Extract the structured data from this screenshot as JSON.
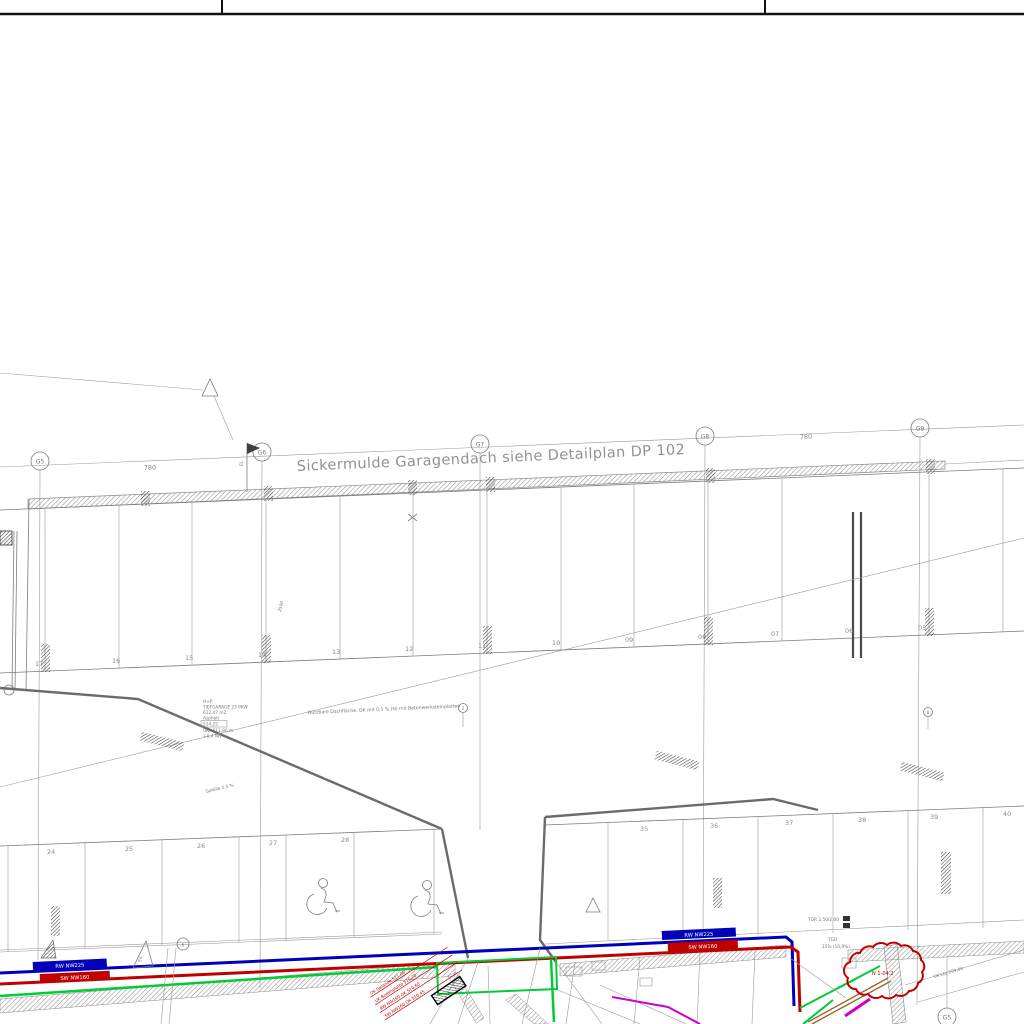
{
  "sheet": {
    "background": "#ffffff",
    "line_gray": "#7d7d7d",
    "accent_blue": "#0000bb",
    "accent_red": "#c00000",
    "accent_green": "#00cc33",
    "accent_magenta": "#cc00cc"
  },
  "title_note": "Sickermulde Garagendach siehe Detailplan DP 102",
  "grid": {
    "bubbles": [
      "G5",
      "G6",
      "G7",
      "G8",
      "G9"
    ],
    "bubble_bottom_right": "G5",
    "dims": [
      "780",
      "780"
    ],
    "flag_label": "FL"
  },
  "parking": {
    "row1": [
      "17",
      "16",
      "15",
      "14",
      "13",
      "12",
      "11",
      "10",
      "09",
      "08",
      "07",
      "06",
      "05"
    ],
    "row2_left": [
      "24",
      "25",
      "26",
      "27",
      "28"
    ],
    "row2_right": [
      "35",
      "36",
      "37",
      "38",
      "39",
      "40"
    ]
  },
  "garage_note": {
    "lines": [
      "H+P",
      "TIEFGARAGE 23 PKW",
      "612,47 m2",
      "Asphalt",
      "514,25",
      "UK=511,90 m",
      "+0,4 Niv"
    ]
  },
  "aisle_note": "Nutzbare Dachfläche, OK mit 0,5 % (N) mit Betonwerksteinplatten",
  "markers": {
    "circle_left": "6",
    "circle_mid": "2",
    "circle_right": "8",
    "triangle_label": "E4"
  },
  "pipes": {
    "storm_label": "RW NW225",
    "sewer_label": "SW NW160"
  },
  "ramp": {
    "gate_label": "TOR 2,50/2,00",
    "tgd_label": "TGD",
    "slope_label": "15% (10,9%)"
  },
  "revision_cloud_text": "N 1-04.2",
  "red_annotations": [
    "SW NW160 OK 510,45",
    "RW NW160 OK 510,60",
    "UK Bodenplatte 510,20",
    "OK Gelände 511,05"
  ],
  "misc": {
    "uk_label": "UK Ltg 509,80",
    "diag_label": "Gefälle 2,5 %",
    "dim_small": "2500"
  }
}
